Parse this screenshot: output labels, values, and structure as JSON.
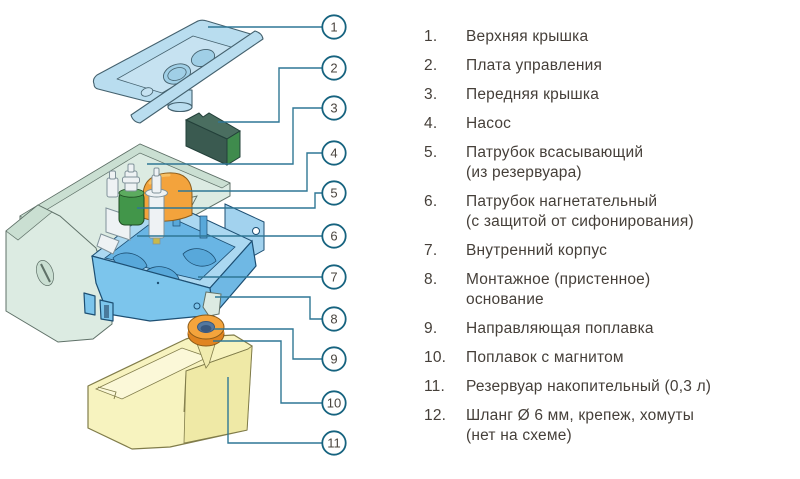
{
  "diagram": {
    "callouts": [
      {
        "n": "1",
        "cx": 334,
        "cy": 27,
        "line": [
          [
            322,
            27
          ],
          [
            208,
            27
          ]
        ]
      },
      {
        "n": "2",
        "cx": 334,
        "cy": 68,
        "line": [
          [
            322,
            68
          ],
          [
            279,
            68
          ],
          [
            279,
            122
          ],
          [
            218,
            122
          ]
        ]
      },
      {
        "n": "3",
        "cx": 334,
        "cy": 108,
        "line": [
          [
            322,
            108
          ],
          [
            293,
            108
          ],
          [
            293,
            164
          ],
          [
            147,
            164
          ]
        ]
      },
      {
        "n": "4",
        "cx": 334,
        "cy": 153,
        "line": [
          [
            322,
            153
          ],
          [
            307,
            153
          ],
          [
            307,
            191
          ],
          [
            178,
            191
          ]
        ]
      },
      {
        "n": "5",
        "cx": 334,
        "cy": 193,
        "line": [
          [
            322,
            193
          ],
          [
            315,
            193
          ],
          [
            315,
            208
          ],
          [
            137,
            208
          ]
        ]
      },
      {
        "n": "6",
        "cx": 334,
        "cy": 236,
        "line": [
          [
            322,
            236
          ],
          [
            137,
            236
          ]
        ]
      },
      {
        "n": "7",
        "cx": 334,
        "cy": 277,
        "line": [
          [
            322,
            277
          ],
          [
            198,
            277
          ]
        ]
      },
      {
        "n": "8",
        "cx": 334,
        "cy": 319,
        "line": [
          [
            322,
            319
          ],
          [
            310,
            319
          ],
          [
            310,
            297
          ],
          [
            215,
            297
          ]
        ]
      },
      {
        "n": "9",
        "cx": 334,
        "cy": 359,
        "line": [
          [
            322,
            359
          ],
          [
            293,
            359
          ],
          [
            293,
            329
          ],
          [
            214,
            329
          ]
        ]
      },
      {
        "n": "10",
        "cx": 334,
        "cy": 403,
        "line": [
          [
            322,
            403
          ],
          [
            281,
            403
          ],
          [
            281,
            341
          ],
          [
            213,
            341
          ]
        ]
      },
      {
        "n": "11",
        "cx": 334,
        "cy": 443,
        "line": [
          [
            322,
            443
          ],
          [
            228,
            443
          ],
          [
            228,
            377
          ]
        ]
      }
    ]
  },
  "parts_list": {
    "items": [
      {
        "num": "1.",
        "lines": [
          "Верхняя крышка"
        ]
      },
      {
        "num": "2.",
        "lines": [
          "Плата управления"
        ]
      },
      {
        "num": "3.",
        "lines": [
          "Передняя крышка"
        ]
      },
      {
        "num": "4.",
        "lines": [
          "Насос"
        ]
      },
      {
        "num": "5.",
        "lines": [
          "Патрубок всасывающий",
          "(из резервуара)"
        ]
      },
      {
        "num": "6.",
        "lines": [
          "Патрубок нагнетательный",
          "(с защитой от сифонирования)"
        ]
      },
      {
        "num": "7.",
        "lines": [
          "Внутренний корпус"
        ]
      },
      {
        "num": "8.",
        "lines": [
          "Монтажное (пристенное)",
          "основание"
        ]
      },
      {
        "num": "9.",
        "lines": [
          "Направляющая поплавка"
        ]
      },
      {
        "num": "10.",
        "lines": [
          "Поплавок с магнитом"
        ]
      },
      {
        "num": "11.",
        "lines": [
          "Резервуар накопительный (0,3 л)"
        ]
      },
      {
        "num": "12.",
        "lines": [
          "Шланг Ø 6 мм, крепеж, хомуты",
          "(нет на схеме)"
        ]
      }
    ]
  },
  "colors": {
    "outline_dark": "#44616e",
    "top_cover": "#b9ddef",
    "top_cover_ports": "#a0cfe6",
    "cover_recess": "#c6e2f1",
    "board_front": "#3a5a50",
    "board_side": "#3f8b4d",
    "board_top": "#4a6e60",
    "board_outline": "#23403a",
    "shell": "#dcebe2",
    "shell_band": "#cadfd2",
    "shell_outline": "#5f7168",
    "box": "#7cc5ec",
    "box_dark": "#6fb8e4",
    "box_inner": "#abd8f1",
    "box_floor": "#69b5e4",
    "box_rib": "#58a8da",
    "box_wing": "#a2d2ee",
    "box_outline": "#1d4f73",
    "pump": "#f3a33c",
    "pump_hi": "#f9c871",
    "pump_outline": "#8a5c1c",
    "pipe_green": "#42964a",
    "pipe_green_top": "#5cab5f",
    "pipe_green_outline": "#1e4a22",
    "white_part": "#eef2f4",
    "white_outline": "#80929a",
    "float_top": "#f4a43c",
    "float_side": "#e08420",
    "float_outline": "#8a5a18",
    "float_hole": "#54789f",
    "float_hole_dark": "#39587e",
    "tank": "#f7f3bf",
    "tank_side": "#efe9a6",
    "tank_inner": "#fbf8d8",
    "funnel": "#f0ebae",
    "tank_outline": "#807c4a",
    "line": "#2f7795",
    "callout_stroke": "#16637f",
    "callout_fill": "#ffffff",
    "callout_text": "#4a443e",
    "list_text": "#453f39"
  }
}
